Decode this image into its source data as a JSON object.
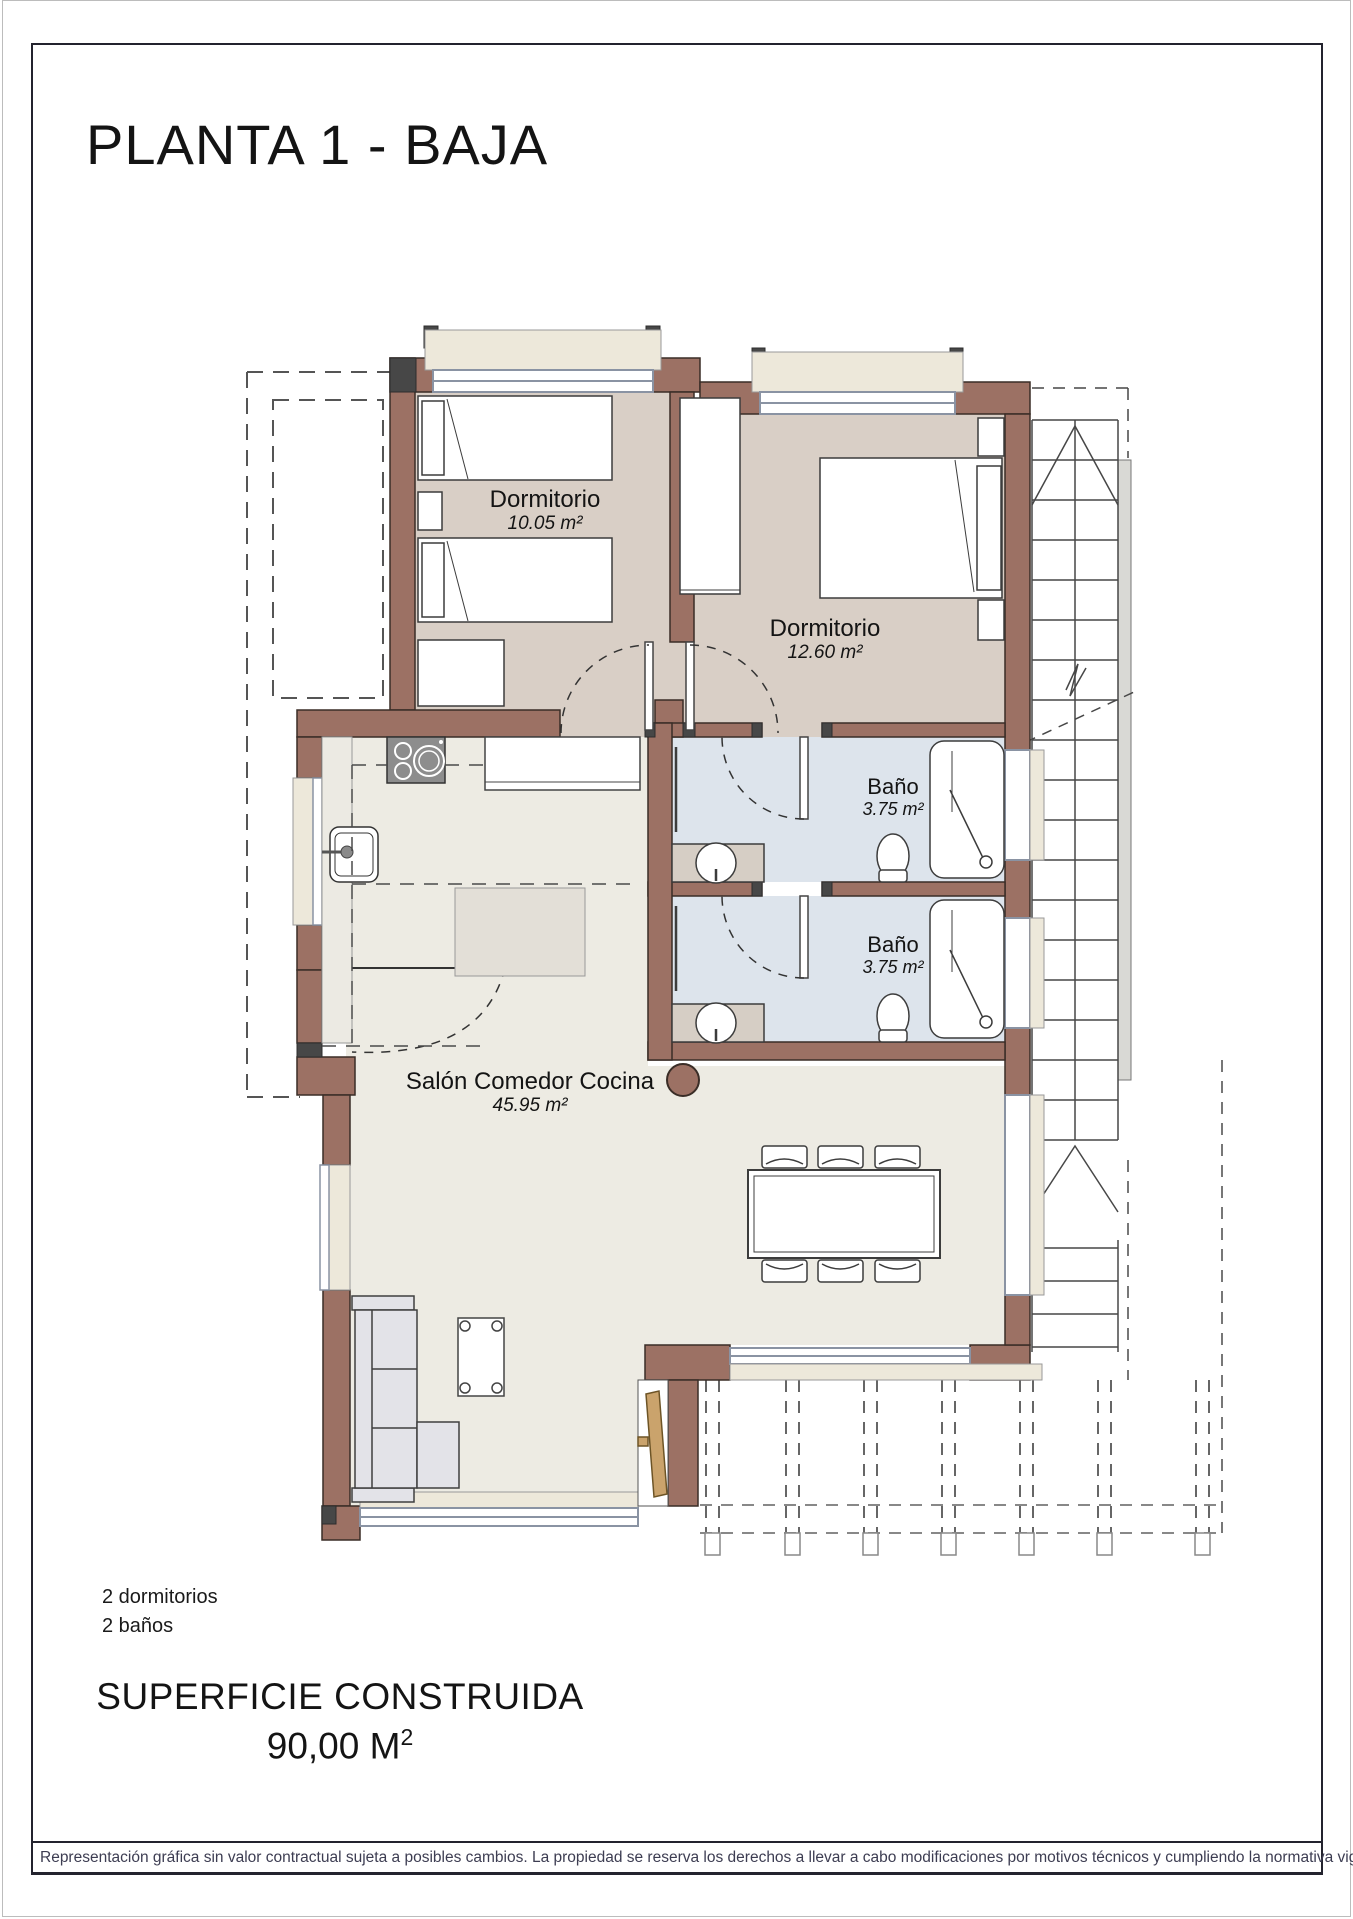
{
  "title": "PLANTA 1 - BAJA",
  "rooms": {
    "bedroom1": {
      "name": "Dormitorio",
      "area": "10.05 m²"
    },
    "bedroom2": {
      "name": "Dormitorio",
      "area": "12.60 m²"
    },
    "bath1": {
      "name": "Baño",
      "area": "3.75 m²"
    },
    "bath2": {
      "name": "Baño",
      "area": "3.75 m²"
    },
    "living": {
      "name": "Salón Comedor Cocina",
      "area": "45.95 m²"
    }
  },
  "summary": {
    "line1": "2 dormitorios",
    "line2": "2 baños"
  },
  "built_area": {
    "label": "SUPERFICIE CONSTRUIDA",
    "value": "90,00 M",
    "superscript": "2"
  },
  "footer": {
    "disclaimer": "Representación gráfica sin valor contractual sujeta a posibles cambios. La propiedad se reserva los derechos a llevar a cabo modificaciones por motivos técnicos y cumpliendo la normativa vigente."
  },
  "colors": {
    "wall": "#9c7164",
    "bedroom_floor": "#d9cfc6",
    "bath_floor": "#dde4ec",
    "living_floor": "#edebe3",
    "window_sill": "#ede8da",
    "window_frame": "#8a93a3"
  }
}
